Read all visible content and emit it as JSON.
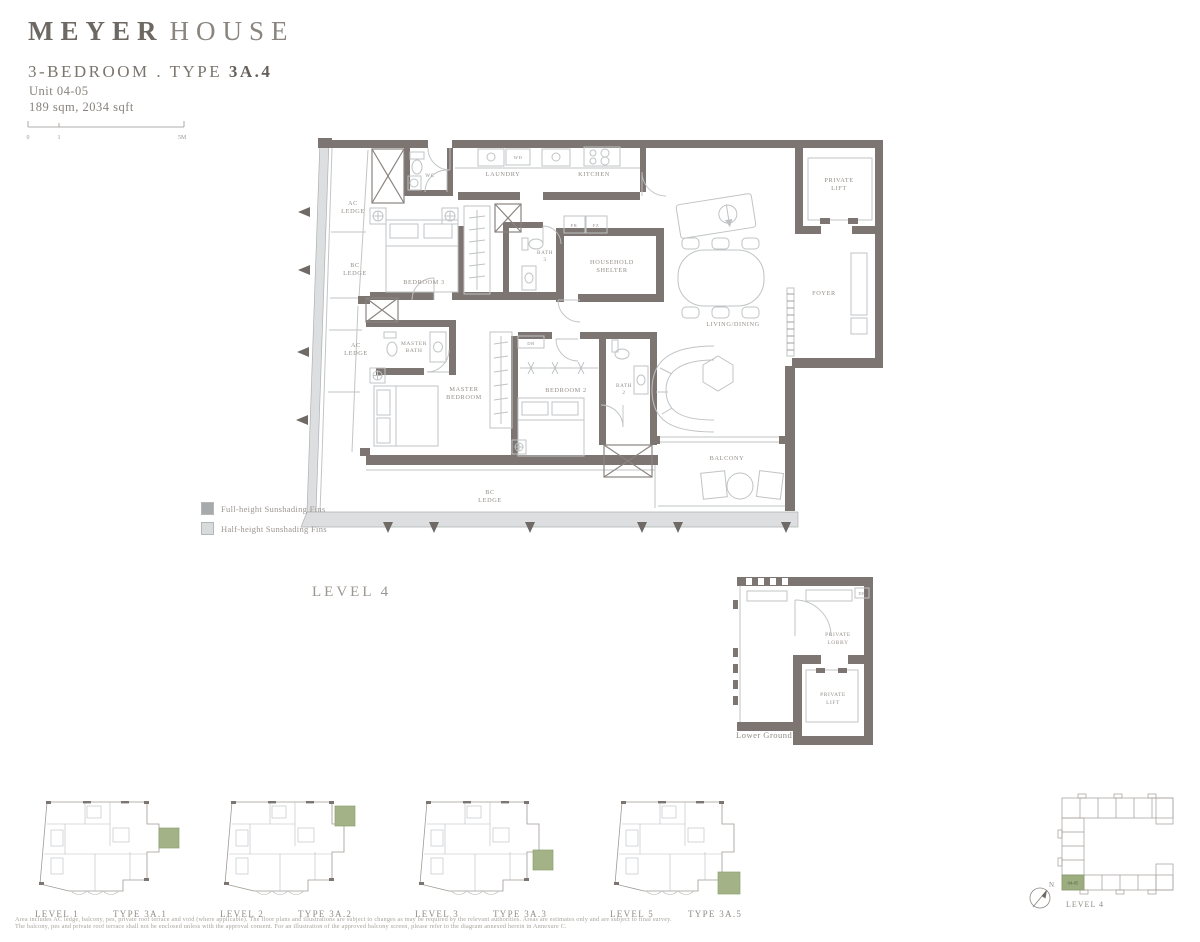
{
  "header": {
    "brand_bold": "MEYER",
    "brand_light": "HOUSE",
    "title_prefix": "3-BEDROOM . TYPE ",
    "title_bold": "3A.4",
    "unit": "Unit 04-05",
    "area": "189 sqm, 2034 sqft"
  },
  "scale_bar": {
    "tick0": "0",
    "tick1": "1",
    "tick2": "5M"
  },
  "plan": {
    "caption": "LEVEL 4",
    "labels": {
      "ac_ledge_top_1": "AC",
      "ac_ledge_top_2": "LEDGE",
      "bc_ledge_left_1": "BC",
      "bc_ledge_left_2": "LEDGE",
      "wc": "WC",
      "laundry": "LAUNDRY",
      "wd": "WD",
      "kitchen": "KITCHEN",
      "fr": "FR",
      "fz": "FZ",
      "bath3_1": "BATH",
      "bath3_2": "3",
      "household_1": "HOUSEHOLD",
      "household_2": "SHELTER",
      "bedroom3": "BEDROOM 3",
      "private_lift_1": "PRIVATE",
      "private_lift_2": "LIFT",
      "foyer": "FOYER",
      "living": "LIVING/DINING",
      "ac_ledge_mid_1": "AC",
      "ac_ledge_mid_2": "LEDGE",
      "master_bath_1": "MASTER",
      "master_bath_2": "BATH",
      "master_bedroom_1": "MASTER",
      "master_bedroom_2": "BEDROOM",
      "db": "DB",
      "bedroom2": "BEDROOM 2",
      "bath2_1": "BATH",
      "bath2_2": "2",
      "balcony": "BALCONY",
      "bc_ledge_bottom_1": "BC",
      "bc_ledge_bottom_2": "LEDGE"
    }
  },
  "legend": {
    "full": "Full-height Sunshading Fins",
    "half": "Half-height Sunshading Fins"
  },
  "lower_ground": {
    "caption": "Lower Ground",
    "lobby_1": "PRIVATE",
    "lobby_2": "LOBBY",
    "lift_1": "PRIVATE",
    "lift_2": "LIFT",
    "db": "DB"
  },
  "mini_plans": [
    {
      "level": "LEVEL 1",
      "type": "TYPE 3A.1"
    },
    {
      "level": "LEVEL 2",
      "type": "TYPE 3A.2"
    },
    {
      "level": "LEVEL 3",
      "type": "TYPE 3A.3"
    },
    {
      "level": "LEVEL 5",
      "type": "TYPE 3A.5"
    }
  ],
  "key_plan": {
    "unit": "04-05",
    "caption": "LEVEL 4",
    "north": "N"
  },
  "disclaimer": {
    "line1": "Area includes AC ledge, balcony, pes, private roof terrace and void (where applicable). The floor plans and illustrations are subject to changes as may be required by the relevant authorities. Areas are estimates only and are subject to final survey.",
    "line2": "The balcony, pes and private roof terrace shall not be enclosed unless with the approval consent. For an illustration of the approved balcony screen, please refer to the diagram annexed herein in Annexure C."
  },
  "colors": {
    "wall": "#7c7571",
    "thin_line": "#c2c5c6",
    "fin_band": "#dcdedf",
    "accent_green": "#a4b287",
    "label": "#948f89"
  }
}
